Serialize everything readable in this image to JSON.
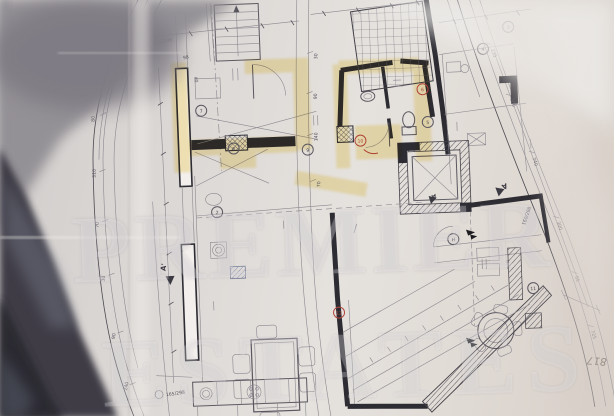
{
  "meta": {
    "description": "Photograph of an architectural floor plan sheet",
    "sheet_number": "817"
  },
  "watermark": {
    "line1": "PREMIER",
    "line2": "ESTATES"
  },
  "section_markers": {
    "m1": "А'",
    "m2": "А",
    "m3": "А'"
  },
  "window_labels": {
    "top": "165/298",
    "top_small": "98",
    "top_small2": "40",
    "bottom": "165/298",
    "right": "160/298"
  },
  "dims": {
    "left": [
      "440",
      "80",
      "310",
      "70",
      "30",
      "90",
      "240"
    ],
    "mid": [
      "30",
      "90",
      "140",
      "70"
    ],
    "right": [
      "235",
      "300",
      "740",
      "300",
      "55",
      "725"
    ]
  },
  "room_tags": {
    "t1": "3",
    "t2": "4",
    "t3": "5",
    "t4": "6",
    "t5": "7",
    "t6": "8",
    "t7": "9",
    "t8": "10",
    "t9": "11",
    "t10": "12",
    "t11": "H",
    "t12": "2"
  },
  "colors": {
    "paper": "#dbd7d3",
    "ink": "#46434c",
    "wall": "#2d2c33",
    "highlight": "#f2d35c",
    "red_mark": "#b0443c",
    "shadow_dark": "#36343d",
    "shadow_gray": "#908d93",
    "hatch_blue": "#8a94b5"
  }
}
